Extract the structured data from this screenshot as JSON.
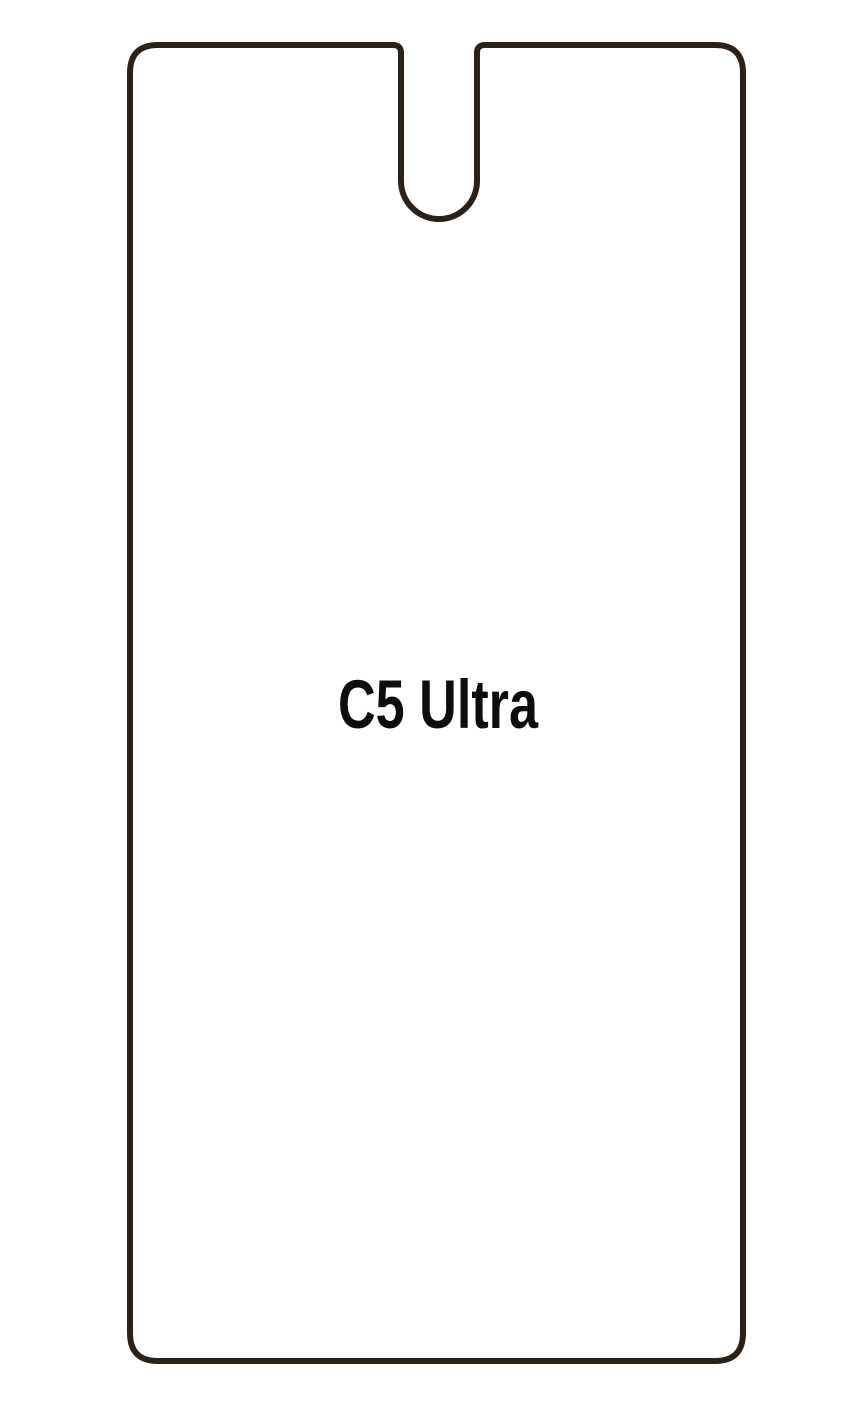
{
  "page": {
    "background_color": "#ffffff"
  },
  "protector": {
    "label": "C5 Ultra",
    "outline_color": "#29211a",
    "label_color": "#0d0d0d"
  }
}
